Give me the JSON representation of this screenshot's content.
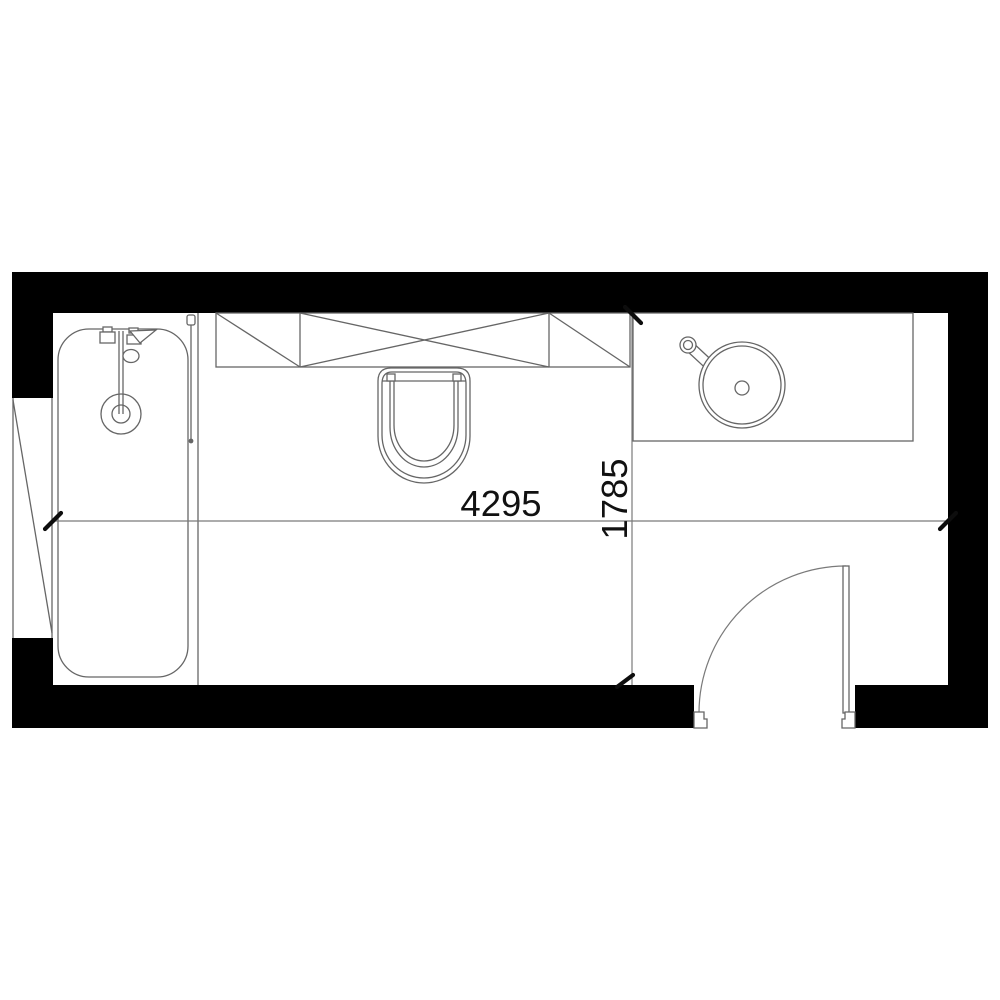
{
  "plan": {
    "kind": "bathroom-floor-plan",
    "dimensions": {
      "width_label": "4295",
      "depth_label": "1785"
    },
    "fixtures": [
      "bathtub",
      "bathtub-faucet",
      "shower-screen",
      "storage-cabinet",
      "toilet",
      "vanity-counter",
      "washbasin",
      "basin-faucet",
      "door",
      "window"
    ],
    "colors": {
      "wall": "#000000",
      "fixture_line": "#666666",
      "dimension_line": "#7a7a7a",
      "dimension_text": "#111111",
      "background": "#ffffff"
    }
  }
}
